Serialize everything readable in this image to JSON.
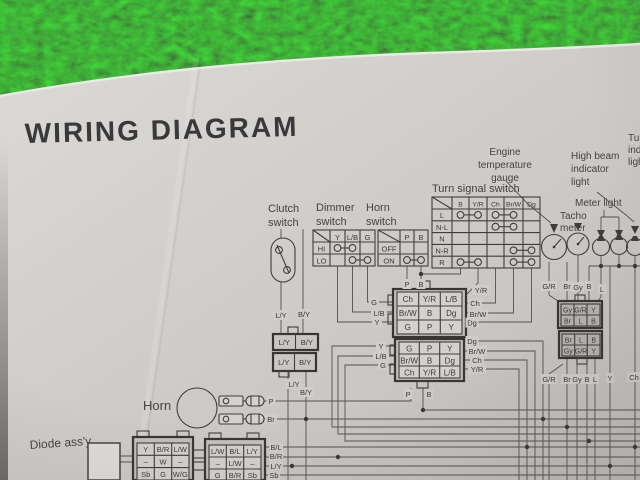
{
  "colors": {
    "paper": "#d1cecb",
    "ink": "#3b3936",
    "grass_green": "#2c5a2e"
  },
  "title": "WIRING DIAGRAM",
  "labels": {
    "clutch": [
      "Clutch",
      "switch"
    ],
    "dimmer": [
      "Dimmer",
      "switch"
    ],
    "horn_switch": [
      "Horn",
      "switch"
    ],
    "turn_signal": "Turn signal switch",
    "engine_gauge": [
      "Engine",
      "temperature",
      "gauge"
    ],
    "high_beam": [
      "High beam",
      "indicator",
      "light"
    ],
    "turn_indicator_cut": [
      "Tur",
      "indi",
      "ligh"
    ],
    "meter_light": "Meter light",
    "tacho": [
      "Tacho",
      "meter"
    ],
    "horn": "Horn",
    "diode": "Diode ass'y"
  },
  "tables": {
    "dimmer": {
      "cols": [
        "Y",
        "L/B",
        "G"
      ],
      "rows": [
        "HI",
        "LO"
      ]
    },
    "horn": {
      "cols": [
        "P",
        "B"
      ],
      "rows": [
        "OFF",
        "ON"
      ]
    },
    "turn": {
      "cols": [
        "B",
        "Y/R",
        "Ch",
        "Br/W",
        "Dg"
      ],
      "rows": [
        "L",
        "N-L",
        "N",
        "N-R",
        "R"
      ]
    }
  },
  "conn": {
    "mu": [
      [
        "Ch",
        "Y/R",
        "L/B"
      ],
      [
        "Br/W",
        "B",
        "Dg"
      ],
      [
        "G",
        "P",
        "Y"
      ]
    ],
    "ml": [
      [
        "G",
        "P",
        "Y"
      ],
      [
        "Br/W",
        "B",
        "Dg"
      ],
      [
        "Ch",
        "Y/R",
        "L/B"
      ]
    ],
    "tu": [
      [
        "Gy",
        "G/R",
        "Y"
      ],
      [
        "Br",
        "L",
        "B"
      ]
    ],
    "tl": [
      [
        "Br",
        "L",
        "B"
      ],
      [
        "Gy",
        "G/R",
        "Y"
      ]
    ],
    "cu": [
      "L/Y",
      "B/Y"
    ],
    "cl": [
      "L/Y",
      "B/Y"
    ],
    "bl": [
      [
        "Y",
        "B/R",
        "L/W"
      ],
      [
        "–",
        "W",
        "–"
      ],
      [
        "Sb",
        "G",
        "W/G"
      ]
    ],
    "br": [
      [
        "L/W",
        "B/L",
        "L/Y"
      ],
      [
        "–",
        "L/W",
        "–"
      ],
      [
        "G",
        "B/R",
        "Sb"
      ]
    ]
  },
  "wires": {
    "ly_a": "L/Y",
    "by_a": "B/Y",
    "ly_b": "L/Y",
    "by_b": "B/Y",
    "g_u": "G",
    "lb_u": "L/B",
    "y_u": "Y",
    "p_u": "P",
    "b_u": "B",
    "yr_u": "Y/R",
    "ch_u": "Ch",
    "brw_u": "Br/W",
    "dg_u": "Dg",
    "y_l": "Y",
    "lb_l": "L/B",
    "g_l": "G",
    "dg_l": "Dg",
    "brw_l": "Br/W",
    "ch_l": "Ch",
    "yr_l": "Y/R",
    "p_l": "P",
    "b_l": "B",
    "horn_p": "P",
    "horn_br": "Br",
    "gr_a": "G/R",
    "br_a": "Br",
    "gy_a": "Gy",
    "b_a": "B",
    "l_a": "L",
    "gr_b": "G/R",
    "br_b": "Br",
    "gy_b": "Gy",
    "b_b": "B",
    "l_b": "L",
    "y_b": "Y",
    "ch_b": "Ch",
    "bl": "B/L",
    "brr": "B/R",
    "lyr": "L/Y",
    "sbr": "Sb"
  }
}
